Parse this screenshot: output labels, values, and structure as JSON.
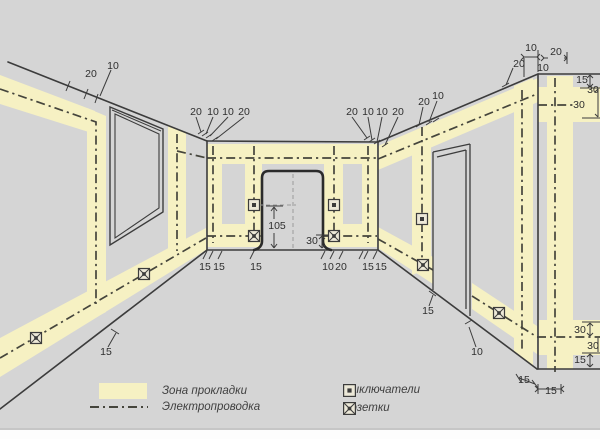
{
  "colors": {
    "bg": "#d5d5d5",
    "zone": "#f6f1c3",
    "line": "#3c3c3c",
    "wiring": "#45453c",
    "door": "#2b2b2b",
    "dim_text": "#2f2f2f",
    "aux": "#9a9a9a",
    "icon_fill": "#ece8d8"
  },
  "legend": {
    "zone": "Зона прокладки",
    "wiring": "Электропроводка",
    "switches": "Выключатели",
    "sockets": "Розетки"
  },
  "diagram": {
    "canvas": {
      "w": 600,
      "h": 439
    },
    "zones": [
      "0,75 95,111 95,134 0,104",
      "87,108 106,116 106,312 87,322",
      "168,125 186,133 186,252 168,259",
      "0,338 206,228 206,250 0,377",
      "207,144 377,144 377,164 207,164",
      "207,224 262,224 262,247 207,247",
      "324,224 377,224 377,247 324,247",
      "207,144 222,144 222,247 207,247",
      "245,144 262,144 262,247 245,247",
      "324,144 343,144 343,247 324,247",
      "362,144 377,144 377,247 362,247",
      "378,146 538,78 538,102 378,170",
      "412,134 431,126 431,268 412,275",
      "378,227 433,257 433,284 378,248",
      "472,283 537,326 537,354 472,309",
      "538,87 600,87 600,122 538,122",
      "538,320 600,320 600,355 538,355",
      "514,86 533,78 533,366 514,352",
      "547,76 573,76 573,369 547,369"
    ],
    "wall_lines": [
      [
        8,
        62,
        207,
        141
      ],
      [
        207,
        141,
        378,
        142
      ],
      [
        378,
        142,
        538,
        74
      ],
      [
        538,
        74,
        600,
        74
      ],
      [
        207,
        141,
        207,
        250
      ],
      [
        378,
        142,
        378,
        250
      ],
      [
        538,
        74,
        538,
        369
      ],
      [
        0,
        409,
        207,
        250
      ],
      [
        207,
        250,
        378,
        250
      ],
      [
        378,
        250,
        537,
        369
      ],
      [
        537,
        369,
        600,
        369
      ]
    ],
    "window": {
      "outer": "110,107 163,129 163,212 110,245",
      "inner": "115,114 159,134 159,208 115,238",
      "top": "112,110 161,131"
    },
    "right_doorway": [
      [
        433,
        152,
        470,
        144
      ],
      [
        470,
        144,
        470,
        316
      ],
      [
        433,
        152,
        433,
        290
      ],
      [
        437,
        157,
        466,
        150
      ],
      [
        466,
        150,
        466,
        309
      ]
    ],
    "center_door_path": "M 254 250 Q 262 248 262 241 L 262 178 Q 262 171 269 171 L 316 171 Q 323 171 323 178 L 323 241 Q 323 248 331 250",
    "wiring": [
      "0,89 96,122 96,304",
      "0,358 206,238",
      "177,134 177,251",
      "177,151 207,158",
      "207,158 377,158",
      "207,236 262,236",
      "324,236 377,236",
      "213,146 213,243",
      "254,146 254,239",
      "334,146 334,239",
      "368,146 368,243",
      "378,159 537,94",
      "422,127 422,267",
      "378,239 433,270",
      "472,296 537,337",
      "537,337 600,337",
      "538,105 573,105",
      "522,90 522,352",
      "555,78 555,372"
    ],
    "aux_dashed": [
      [
        293,
        174,
        293,
        249
      ],
      [
        259,
        205,
        296,
        205
      ]
    ],
    "dim_lines": [
      [
        70,
        81,
        66,
        91
      ],
      [
        88,
        89,
        84,
        99
      ],
      [
        98,
        94,
        95,
        103
      ],
      [
        111,
        70,
        100,
        96
      ],
      [
        196,
        117,
        201,
        132
      ],
      [
        213,
        117,
        206,
        134
      ],
      [
        228,
        117,
        210,
        136
      ],
      [
        244,
        117,
        216,
        139
      ],
      [
        198,
        134,
        204,
        130
      ],
      [
        202,
        136,
        208,
        132
      ],
      [
        206,
        138,
        212,
        134
      ],
      [
        212,
        141,
        218,
        137
      ],
      [
        352,
        117,
        367,
        138
      ],
      [
        368,
        117,
        372,
        140
      ],
      [
        382,
        117,
        377,
        142
      ],
      [
        398,
        117,
        385,
        145
      ],
      [
        364,
        140,
        370,
        136
      ],
      [
        369,
        142,
        375,
        138
      ],
      [
        374,
        144,
        380,
        140
      ],
      [
        382,
        147,
        388,
        143
      ],
      [
        423,
        107,
        419,
        125
      ],
      [
        437,
        101,
        429,
        122
      ],
      [
        416,
        127,
        422,
        123
      ],
      [
        426,
        125,
        432,
        121
      ],
      [
        433,
        122,
        439,
        118
      ],
      [
        524,
        58,
        524,
        77
      ],
      [
        538,
        50,
        538,
        72
      ],
      [
        524,
        57,
        537,
        57
      ],
      [
        544,
        58,
        548,
        58
      ],
      [
        564,
        58,
        567,
        58
      ],
      [
        567,
        52,
        567,
        64
      ],
      [
        513,
        68,
        506,
        85
      ],
      [
        502,
        87,
        509,
        83
      ],
      [
        521,
        54,
        524,
        57
      ],
      [
        521,
        60,
        524,
        57
      ],
      [
        540,
        54,
        537,
        57
      ],
      [
        540,
        60,
        537,
        57
      ],
      [
        541,
        55,
        544,
        58
      ],
      [
        541,
        61,
        544,
        58
      ],
      [
        564,
        55,
        567,
        58
      ],
      [
        564,
        61,
        567,
        58
      ],
      [
        580,
        88,
        600,
        88
      ],
      [
        590,
        75,
        590,
        87
      ],
      [
        587,
        78,
        590,
        75
      ],
      [
        593,
        78,
        590,
        75
      ],
      [
        587,
        84,
        590,
        87
      ],
      [
        593,
        84,
        590,
        87
      ],
      [
        598,
        89,
        598,
        117
      ],
      [
        595,
        92,
        598,
        89
      ],
      [
        595,
        114,
        598,
        117
      ],
      [
        582,
        118,
        600,
        118
      ],
      [
        207,
        251,
        203,
        259
      ],
      [
        213,
        251,
        209,
        259
      ],
      [
        222,
        251,
        218,
        259
      ],
      [
        254,
        251,
        250,
        259
      ],
      [
        325,
        251,
        321,
        259
      ],
      [
        334,
        251,
        330,
        259
      ],
      [
        343,
        251,
        339,
        259
      ],
      [
        363,
        251,
        359,
        259
      ],
      [
        368,
        251,
        364,
        259
      ],
      [
        377,
        251,
        373,
        259
      ],
      [
        274,
        207,
        274,
        219
      ],
      [
        274,
        233,
        274,
        248
      ],
      [
        271,
        211,
        274,
        207
      ],
      [
        277,
        211,
        274,
        207
      ],
      [
        271,
        244,
        274,
        248
      ],
      [
        277,
        244,
        274,
        248
      ],
      [
        266,
        206,
        283,
        206
      ],
      [
        322,
        236,
        322,
        248
      ],
      [
        319,
        239,
        322,
        236
      ],
      [
        325,
        239,
        322,
        236
      ],
      [
        319,
        245,
        322,
        248
      ],
      [
        325,
        245,
        322,
        248
      ],
      [
        316,
        235,
        328,
        235
      ],
      [
        429,
        306,
        433,
        295
      ],
      [
        429,
        291,
        436,
        296
      ],
      [
        476,
        347,
        469,
        327
      ],
      [
        465,
        324,
        472,
        320
      ],
      [
        108,
        347,
        116,
        333
      ],
      [
        111,
        329,
        119,
        334
      ],
      [
        519,
        378,
        535,
        384
      ],
      [
        516,
        374,
        521,
        382
      ],
      [
        532,
        380,
        538,
        388
      ],
      [
        538,
        389,
        561,
        389
      ],
      [
        538,
        384,
        538,
        394
      ],
      [
        561,
        384,
        561,
        394
      ],
      [
        535,
        386,
        538,
        389
      ],
      [
        535,
        392,
        538,
        389
      ],
      [
        564,
        386,
        561,
        389
      ],
      [
        564,
        392,
        561,
        389
      ],
      [
        582,
        322,
        600,
        322
      ],
      [
        590,
        323,
        590,
        336
      ],
      [
        587,
        326,
        590,
        323
      ],
      [
        593,
        326,
        590,
        323
      ],
      [
        587,
        333,
        590,
        336
      ],
      [
        593,
        333,
        590,
        336
      ],
      [
        598,
        338,
        598,
        352
      ],
      [
        582,
        353,
        600,
        353
      ],
      [
        590,
        354,
        590,
        367
      ],
      [
        587,
        357,
        590,
        354
      ],
      [
        593,
        357,
        590,
        354
      ],
      [
        587,
        364,
        590,
        367
      ],
      [
        593,
        364,
        590,
        367
      ]
    ],
    "dim_labels": [
      {
        "t": "20",
        "x": 91,
        "y": 74
      },
      {
        "t": "10",
        "x": 113,
        "y": 66
      },
      {
        "t": "20",
        "x": 196,
        "y": 112
      },
      {
        "t": "10",
        "x": 213,
        "y": 112
      },
      {
        "t": "10",
        "x": 228,
        "y": 112
      },
      {
        "t": "20",
        "x": 244,
        "y": 112
      },
      {
        "t": "20",
        "x": 352,
        "y": 112
      },
      {
        "t": "10",
        "x": 368,
        "y": 112
      },
      {
        "t": "10",
        "x": 382,
        "y": 112
      },
      {
        "t": "20",
        "x": 398,
        "y": 112
      },
      {
        "t": "20",
        "x": 424,
        "y": 102
      },
      {
        "t": "10",
        "x": 438,
        "y": 96
      },
      {
        "t": "20",
        "x": 519,
        "y": 64
      },
      {
        "t": "10",
        "x": 531,
        "y": 48
      },
      {
        "t": "20",
        "x": 556,
        "y": 52
      },
      {
        "t": "10",
        "x": 543,
        "y": 68
      },
      {
        "t": "15",
        "x": 582,
        "y": 80
      },
      {
        "t": "30",
        "x": 593,
        "y": 90
      },
      {
        "t": "30",
        "x": 579,
        "y": 105
      },
      {
        "t": "15",
        "x": 205,
        "y": 267
      },
      {
        "t": "15",
        "x": 219,
        "y": 267
      },
      {
        "t": "15",
        "x": 256,
        "y": 267
      },
      {
        "t": "10",
        "x": 328,
        "y": 267
      },
      {
        "t": "20",
        "x": 341,
        "y": 267
      },
      {
        "t": "15",
        "x": 368,
        "y": 267
      },
      {
        "t": "15",
        "x": 381,
        "y": 267
      },
      {
        "t": "105",
        "x": 277,
        "y": 226
      },
      {
        "t": "30",
        "x": 312,
        "y": 241
      },
      {
        "t": "15",
        "x": 428,
        "y": 311
      },
      {
        "t": "10",
        "x": 477,
        "y": 352
      },
      {
        "t": "15",
        "x": 106,
        "y": 352
      },
      {
        "t": "30",
        "x": 580,
        "y": 330
      },
      {
        "t": "30",
        "x": 593,
        "y": 346
      },
      {
        "t": "15",
        "x": 580,
        "y": 360
      },
      {
        "t": "15",
        "x": 524,
        "y": 380
      },
      {
        "t": "15",
        "x": 551,
        "y": 391
      }
    ],
    "switches": [
      [
        254,
        205
      ],
      [
        334,
        205
      ],
      [
        422,
        219
      ]
    ],
    "sockets": [
      [
        254,
        236
      ],
      [
        334,
        236
      ],
      [
        36,
        338
      ],
      [
        144,
        274
      ],
      [
        423,
        265
      ],
      [
        499,
        313
      ]
    ]
  }
}
